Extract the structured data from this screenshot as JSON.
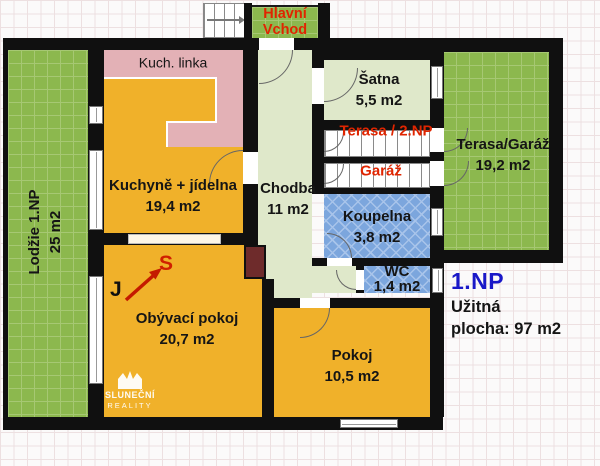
{
  "rooms": {
    "lodzie": {
      "name": "Lodžie 1.NP",
      "area": "25 m2"
    },
    "kitchen": {
      "name": "Kuchyně + jídelna",
      "area": "19,4 m2"
    },
    "kitchen_counter": {
      "name": "Kuch. linka"
    },
    "hallway": {
      "name": "Chodba",
      "area": "11 m2"
    },
    "wardrobe": {
      "name": "Šatna",
      "area": "5,5 m2"
    },
    "bathroom": {
      "name": "Koupelna",
      "area": "3,8 m2"
    },
    "wc": {
      "name": "WC",
      "area": "1,4 m2"
    },
    "living_room": {
      "name": "Obývací pokoj",
      "area": "20,7 m2"
    },
    "bedroom": {
      "name": "Pokoj",
      "area": "10,5 m2"
    },
    "terrace_garage": {
      "name": "Terasa/Garáž",
      "area": "19,2 m2"
    }
  },
  "entrance": {
    "line1": "Hlavní",
    "line2": "Vchod"
  },
  "stairs": {
    "terrace": "Terasa / 2.NP",
    "garage": "Garáž"
  },
  "floor_info": {
    "floor": "1.NP",
    "usable_line1": "Užitná",
    "usable_line2": "plocha: 97 m2"
  },
  "compass": {
    "north": "S",
    "south": "J"
  },
  "watermark": {
    "line1": "SLUNEČNÍ",
    "line2": "REALITY"
  },
  "colors": {
    "wall": "#101010",
    "room_yellow": "#F0B12A",
    "room_pale_green": "#DFE8CA",
    "outdoor_green": "#8CB84E",
    "bathroom_blue": "#7CA6DD",
    "counter_pink": "#E3B1B6",
    "chimney_brown": "#6E2B2B",
    "red_label": "#E02500",
    "floor_label_blue": "#1A18C8"
  }
}
